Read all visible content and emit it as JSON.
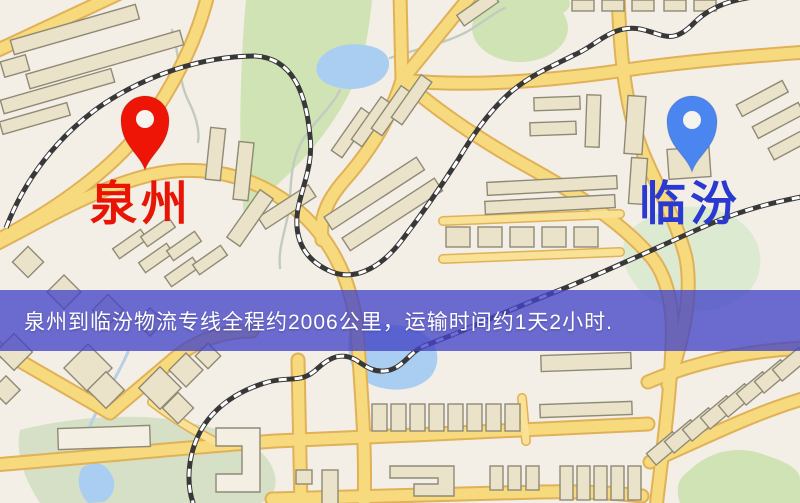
{
  "origin": {
    "label": "泉州",
    "pin_icon": "red-map-pin",
    "pin_color": "#ee1506",
    "label_color": "#e81505"
  },
  "destination": {
    "label": "临汾",
    "pin_icon": "blue-map-pin",
    "pin_color": "#4b86f0",
    "label_color": "#2a3ad0"
  },
  "banner": {
    "text": "泉州到临汾物流专线全程约2006公里，运输时间约1天2小时.",
    "distance_text": "约2006公里",
    "duration_text": "约1天2小时",
    "background": "#4444c6",
    "text_color": "#ffffff"
  },
  "map_colors": {
    "land": "#f3efe6",
    "road_fill": "#f7d97e",
    "road_casing": "#e0b157",
    "park": "#cfe3b4",
    "water": "#a9cef2",
    "building": "#eae2c9",
    "railway": "#383838"
  }
}
